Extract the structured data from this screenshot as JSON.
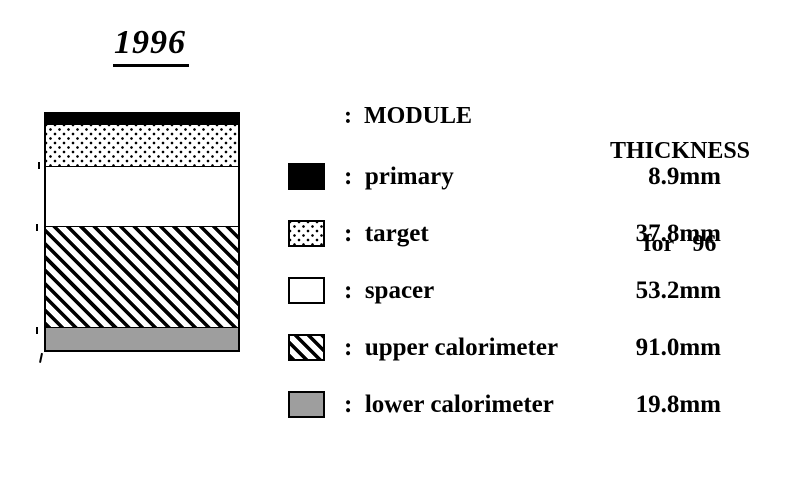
{
  "title": "1996",
  "headers": {
    "module": ":  MODULE",
    "thickness_line1": "THICKNESS",
    "thickness_line2": "for  '96"
  },
  "legend_rows": [
    {
      "name": "primary",
      "pattern": "solid-black",
      "label": ":  primary",
      "value": "8.9mm"
    },
    {
      "name": "target",
      "pattern": "dotted",
      "label": ":  target",
      "value": "37.8mm"
    },
    {
      "name": "spacer",
      "pattern": "white",
      "label": ":  spacer",
      "value": "53.2mm"
    },
    {
      "name": "upper calorimeter",
      "pattern": "diagonal-hatch",
      "label": ":  upper calorimeter",
      "value": "91.0mm"
    },
    {
      "name": "lower calorimeter",
      "pattern": "gray",
      "label": ":  lower calorimeter",
      "value": "19.8mm"
    }
  ],
  "stack_layers": [
    {
      "name": "primary",
      "pattern": "solid-black",
      "thickness_mm": 8.9
    },
    {
      "name": "target",
      "pattern": "dotted",
      "thickness_mm": 37.8
    },
    {
      "name": "spacer",
      "pattern": "white",
      "thickness_mm": 53.2
    },
    {
      "name": "upper calorimeter",
      "pattern": "diagonal-hatch",
      "thickness_mm": 91.0
    },
    {
      "name": "lower calorimeter",
      "pattern": "gray",
      "thickness_mm": 19.8
    }
  ],
  "colors": {
    "ink": "#000000",
    "lower_calorimeter_gray": "#9e9e9e",
    "background": "#ffffff"
  }
}
